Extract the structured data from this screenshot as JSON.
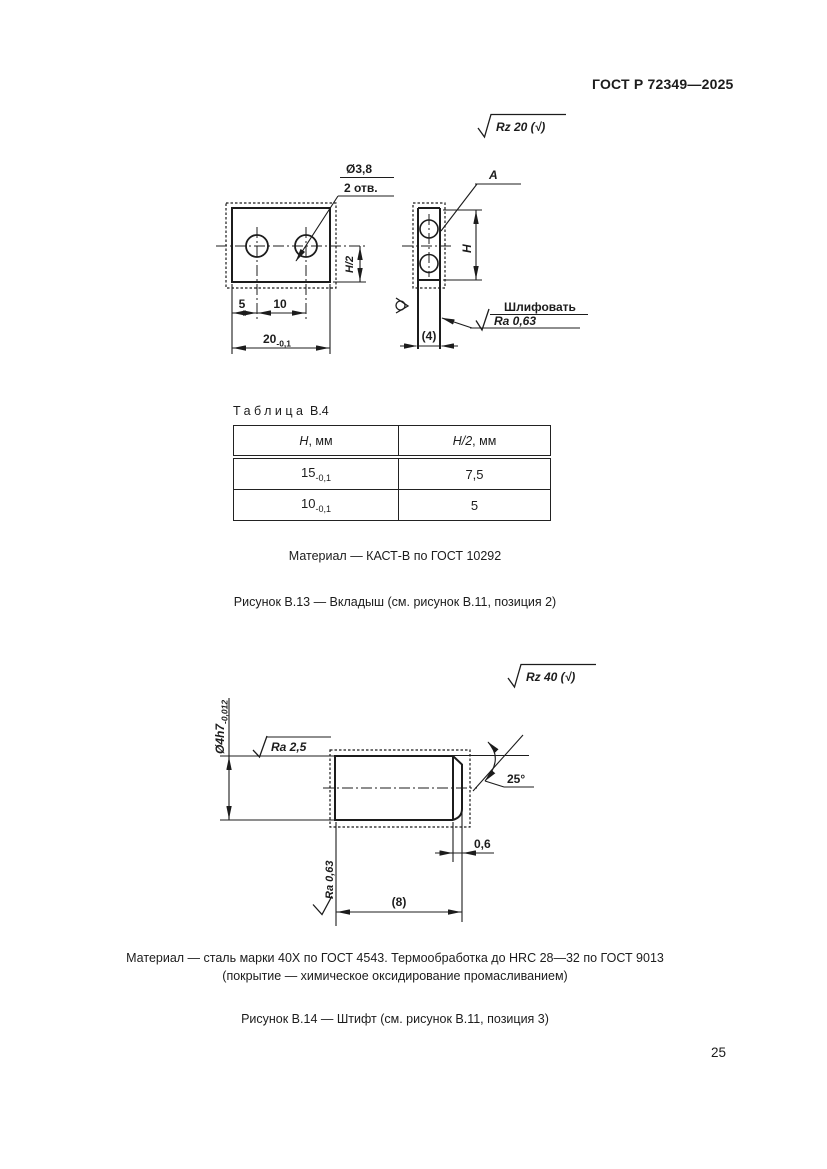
{
  "page": {
    "header_title": "ГОСТ Р 72349—2025",
    "page_number": "25"
  },
  "fig_b13": {
    "roughness_general": "Rz 20 (√)",
    "front": {
      "hole_dia": "Ø3,8",
      "hole_count": "2 отв.",
      "h_half": "H/2",
      "d5": "5",
      "d10": "10",
      "d20": "20",
      "d20_tol": "-0,1"
    },
    "side": {
      "view_label": "A",
      "h": "H",
      "thickness": "(4)",
      "grind": "Шлифовать",
      "grind_ra": "Ra 0,63"
    },
    "table": {
      "title_word": "Таблица",
      "title_number": "В.4",
      "col1_sym": "H",
      "col1_unit": ", мм",
      "col2_sym": "H/2",
      "col2_unit": ", мм",
      "rows": [
        {
          "h": "15",
          "h_tol": "-0,1",
          "h_half": "7,5"
        },
        {
          "h": "10",
          "h_tol": "-0,1",
          "h_half": "5"
        }
      ]
    },
    "material": "Материал — КАСТ-В по ГОСТ 10292",
    "caption": "Рисунок В.13 — Вкладыш (см. рисунок В.11, позиция 2)"
  },
  "fig_b14": {
    "roughness_general": "Rz 40 (√)",
    "dia": "Ø4h7",
    "dia_tol": "-0,012",
    "ra_cyl": "Ra 2,5",
    "angle": "25°",
    "chamfer": "0,6",
    "length": "(8)",
    "ra_face": "Ra 0,63",
    "material_line1": "Материал — сталь марки 40Х по ГОСТ 4543. Термообработка до HRC 28—32 по ГОСТ 9013",
    "material_line2": "(покрытие — химическое оксидирование промасливанием)",
    "caption": "Рисунок В.14 — Штифт (см. рисунок В.11, позиция 3)"
  }
}
